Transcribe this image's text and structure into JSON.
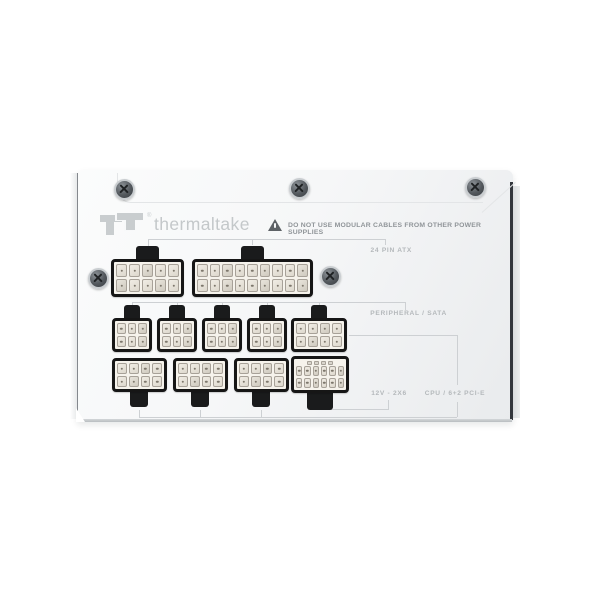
{
  "page": {
    "background": "#ffffff"
  },
  "device": {
    "type": "modular power supply connector panel",
    "brand_wordmark": "thermaltake",
    "logo_mark": "Tt",
    "registered_symbol": "®"
  },
  "warning": {
    "icon": "warning-triangle-icon",
    "text": "DO NOT USE MODULAR CABLES FROM OTHER POWER SUPPLIES"
  },
  "port_groups": {
    "atx": {
      "label": "24 PIN ATX"
    },
    "peripheral": {
      "label": "PERIPHERAL / SATA"
    },
    "gpu_12v2x6": {
      "label": "12V - 2X6"
    },
    "cpu_pcie": {
      "label": "CPU / 6+2 PCI-E"
    }
  },
  "ports": [
    {
      "id": "atx-socket-10pin",
      "group": "24 PIN ATX",
      "grid": "2x5"
    },
    {
      "id": "atx-socket-18pin",
      "group": "24 PIN ATX",
      "grid": "2x9"
    },
    {
      "id": "peripheral-socket-1",
      "group": "PERIPHERAL / SATA",
      "grid": "2x3"
    },
    {
      "id": "peripheral-socket-2",
      "group": "PERIPHERAL / SATA",
      "grid": "2x3"
    },
    {
      "id": "peripheral-socket-3",
      "group": "PERIPHERAL / SATA",
      "grid": "2x3"
    },
    {
      "id": "peripheral-socket-4",
      "group": "PERIPHERAL / SATA",
      "grid": "2x3"
    },
    {
      "id": "cpu-pcie-socket-4",
      "group": "CPU / 6+2 PCI-E",
      "grid": "2x4"
    },
    {
      "id": "cpu-pcie-socket-1",
      "group": "CPU / 6+2 PCI-E",
      "grid": "2x4"
    },
    {
      "id": "cpu-pcie-socket-2",
      "group": "CPU / 6+2 PCI-E",
      "grid": "2x4"
    },
    {
      "id": "cpu-pcie-socket-3",
      "group": "CPU / 6+2 PCI-E",
      "grid": "2x4"
    },
    {
      "id": "12v-2x6-socket",
      "group": "12V - 2X6",
      "grid": "2x6",
      "sense_pins": 4
    }
  ],
  "hardware": {
    "screw_count": 5
  },
  "colors": {
    "body": "#f6f7f8",
    "label_gray": "#b4b8bb",
    "line_gray": "#cdd0d3",
    "logo_gray": "#c9cdcf",
    "connector_outline": "#161616",
    "pin_beige": "#e6e2d9",
    "right_edge_dark": "#33373d"
  }
}
